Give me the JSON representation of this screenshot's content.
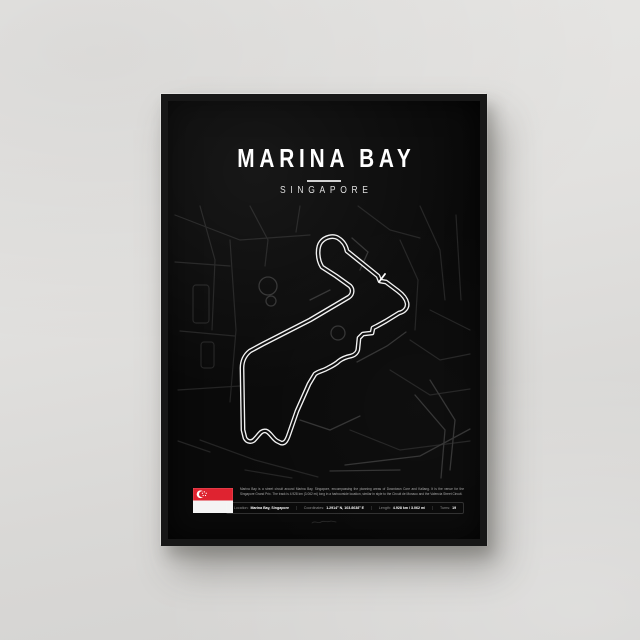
{
  "poster": {
    "title": "MARINA BAY",
    "subtitle": "SINGAPORE",
    "circuit_name": "Marina Bay Street Circuit",
    "description": "Marina Bay is a street circuit around Marina Bay, Singapore, encompassing the planning areas of Downtown Core and Kallang. It is the venue for the Singapore Grand Prix. The track is 4.928 km (3.062 mi) long in a harbourside location, similar in style to the Circuit de Monaco and the Valencia Street Circuit.",
    "stats": [
      {
        "label": "Location:",
        "value": "Marina Bay, Singapore"
      },
      {
        "label": "Coordinates:",
        "value": "1.2914° N, 103.8638° E"
      },
      {
        "label": "Length:",
        "value": "4.928 km / 3.062 mi"
      },
      {
        "label": "Turns:",
        "value": "19"
      }
    ],
    "flag": "singapore-flag",
    "colors": {
      "poster_background": "#0a0a0a",
      "track_line": "#f2f2f2",
      "map_streets": "#2a2a2a",
      "wall": "#dedddb",
      "frame": "#171717",
      "flag_red": "#df2330",
      "text_primary": "#ffffff",
      "text_muted": "#8f8f8f"
    }
  }
}
